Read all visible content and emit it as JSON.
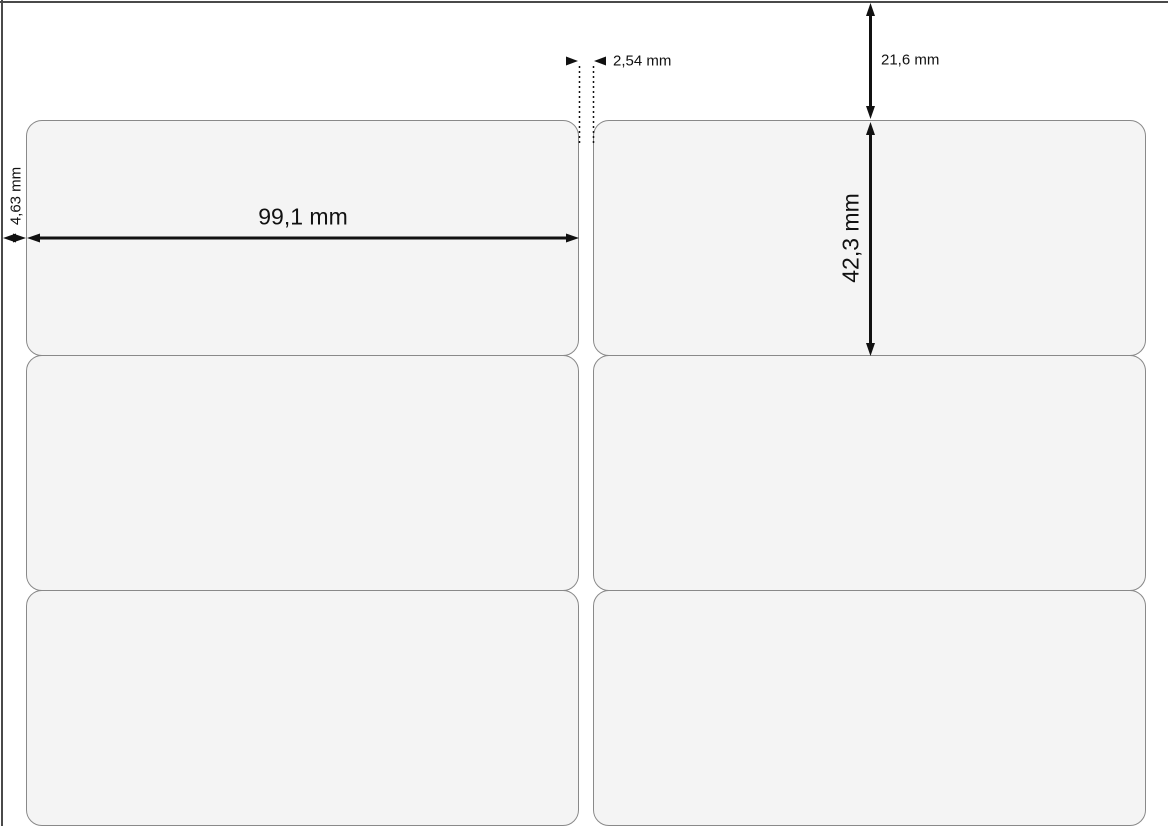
{
  "diagram": {
    "type": "label-sheet-dimension-diagram",
    "dimensions": {
      "label_width": "99,1 mm",
      "label_height": "42,3 mm",
      "top_margin": "21,6 mm",
      "left_margin": "4,63 mm",
      "column_gap": "2,54 mm"
    },
    "sheet": {
      "columns": 2,
      "visible_rows": 3,
      "visible_labels": 6
    },
    "colors": {
      "background": "#ffffff",
      "label_fill": "#f4f4f4",
      "label_border": "#898989",
      "sheet_edge": "#4a4a4a",
      "dimension_ink": "#111111"
    }
  }
}
